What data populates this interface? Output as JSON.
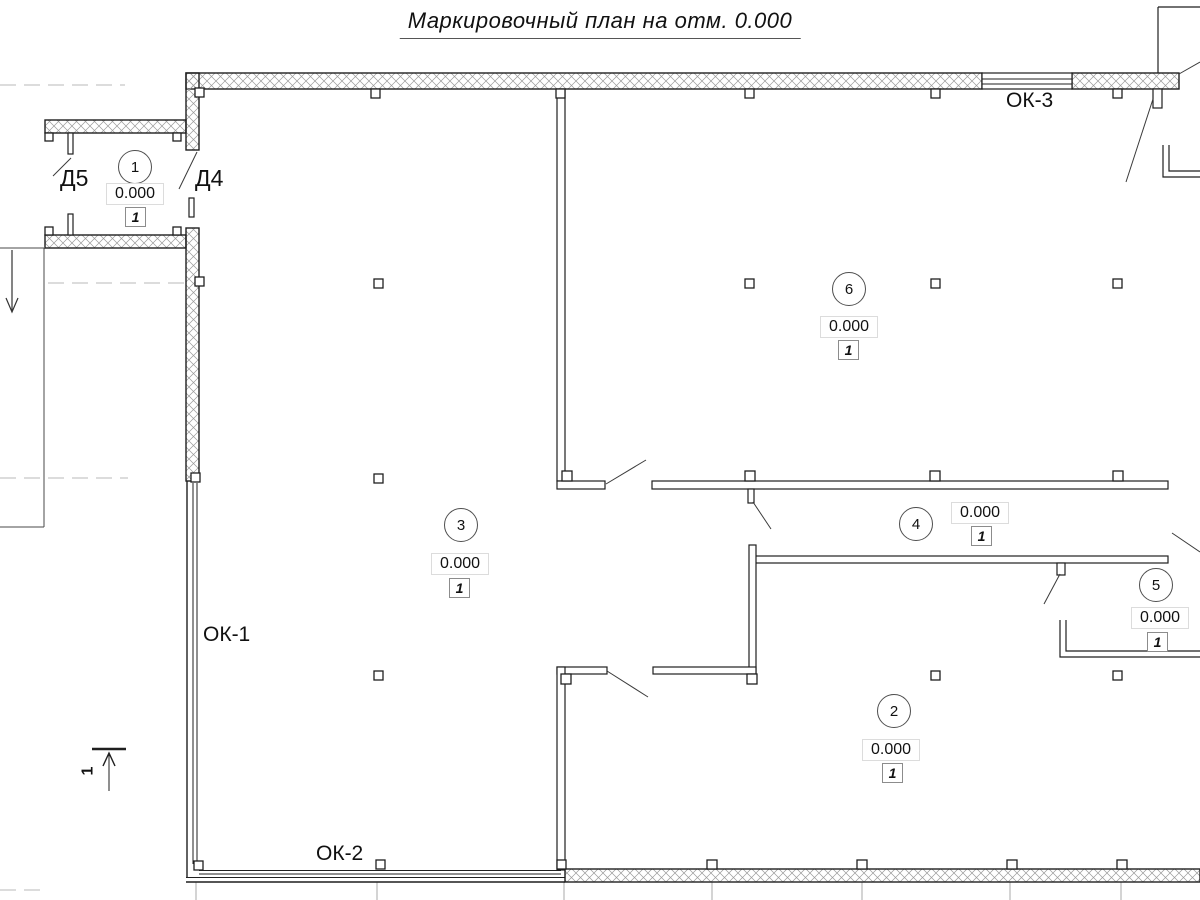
{
  "title": "Маркировочный план на отм. 0.000",
  "plan": {
    "rooms": [
      {
        "number": "1",
        "elevation": "0.000",
        "mark": "1"
      },
      {
        "number": "2",
        "elevation": "0.000",
        "mark": "1"
      },
      {
        "number": "3",
        "elevation": "0.000",
        "mark": "1"
      },
      {
        "number": "4",
        "elevation": "0.000",
        "mark": "1"
      },
      {
        "number": "5",
        "elevation": "0.000",
        "mark": "1"
      },
      {
        "number": "6",
        "elevation": "0.000",
        "mark": "1"
      }
    ],
    "door_labels": [
      {
        "label": "Д5"
      },
      {
        "label": "Д4"
      }
    ],
    "window_labels": [
      {
        "label": "ОК-1"
      },
      {
        "label": "ОК-2"
      },
      {
        "label": "ОК-3"
      }
    ],
    "section_mark": "1"
  },
  "colors": {
    "line": "#1f1f1f",
    "hatch": "#9a9a9a",
    "grid": "#b8b8b8",
    "elevation_box_border": "#dcdcdc",
    "mark_box_border": "#8c8c8c"
  }
}
